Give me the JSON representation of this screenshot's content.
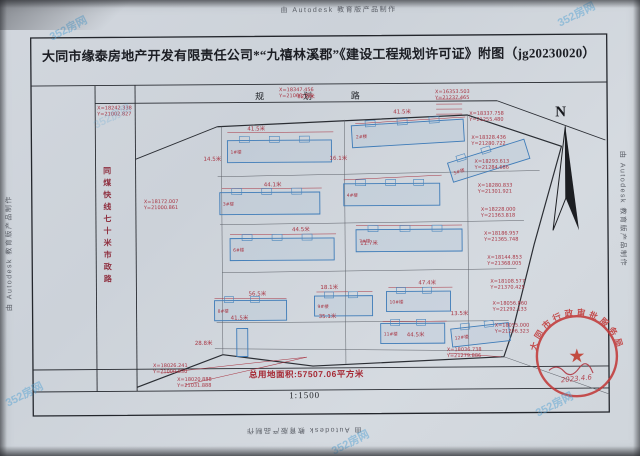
{
  "autodesk_watermark": "由 Autodesk 教育版产品制作",
  "photo_watermark": "352房网",
  "sheet": {
    "title": "大同市缘泰房地产开发有限责任公司*“九禧林溪郡”《建设工程规划许可证》附图（jg20230020）",
    "total_area": "总用地面积:57507.06平方米",
    "scale": "1:1500"
  },
  "plan": {
    "road_top": "规 划 路",
    "road_left": "同煤快线七十米市政路",
    "north": "N",
    "stamp": {
      "ring_text": "大同市行政审批服务局",
      "date": "2023.4.6"
    },
    "coords": [
      {
        "x": "X=18242.338",
        "y": "Y=21002.827"
      },
      {
        "x": "X=18347.456",
        "y": "Y=21066.735"
      },
      {
        "x": "X=16353.503",
        "y": "Y=21237.465"
      },
      {
        "x": "X=18337.758",
        "y": "Y=21255.480"
      },
      {
        "x": "X=18328.436",
        "y": "Y=21280.722"
      },
      {
        "x": "X=18293.613",
        "y": "Y=21284.686"
      },
      {
        "x": "X=18280.833",
        "y": "Y=21301.921"
      },
      {
        "x": "X=18228.000",
        "y": "Y=21363.818"
      },
      {
        "x": "X=18186.957",
        "y": "Y=21365.748"
      },
      {
        "x": "X=18144.853",
        "y": "Y=21368.005"
      },
      {
        "x": "X=18108.577",
        "y": "Y=21370.425"
      },
      {
        "x": "X=18056.860",
        "y": "Y=21292.133"
      },
      {
        "x": "X=18055.000",
        "y": "Y=21296.323"
      },
      {
        "x": "X=18036.738",
        "y": "Y=21279.886"
      },
      {
        "x": "X=18026.241",
        "y": "Y=21000.030"
      },
      {
        "x": "X=18020.888",
        "y": "Y=21031.888"
      },
      {
        "x": "X=18172.007",
        "y": "Y=21000.861"
      }
    ],
    "dims": [
      "41.5米",
      "12.5米",
      "41.5米",
      "14.5米",
      "16.1米",
      "44.1米",
      "44.5米",
      "11.7米",
      "56.5米",
      "18.1米",
      "47.4米",
      "41.5米",
      "35.1米",
      "44.5米",
      "13.5米",
      "28.8米"
    ],
    "buildings": [
      "1#楼",
      "2#楼",
      "3#楼",
      "4#楼",
      "5#楼",
      "6#楼",
      "7#楼",
      "8#楼",
      "9#楼",
      "10#楼",
      "11#楼",
      "12#楼"
    ]
  }
}
